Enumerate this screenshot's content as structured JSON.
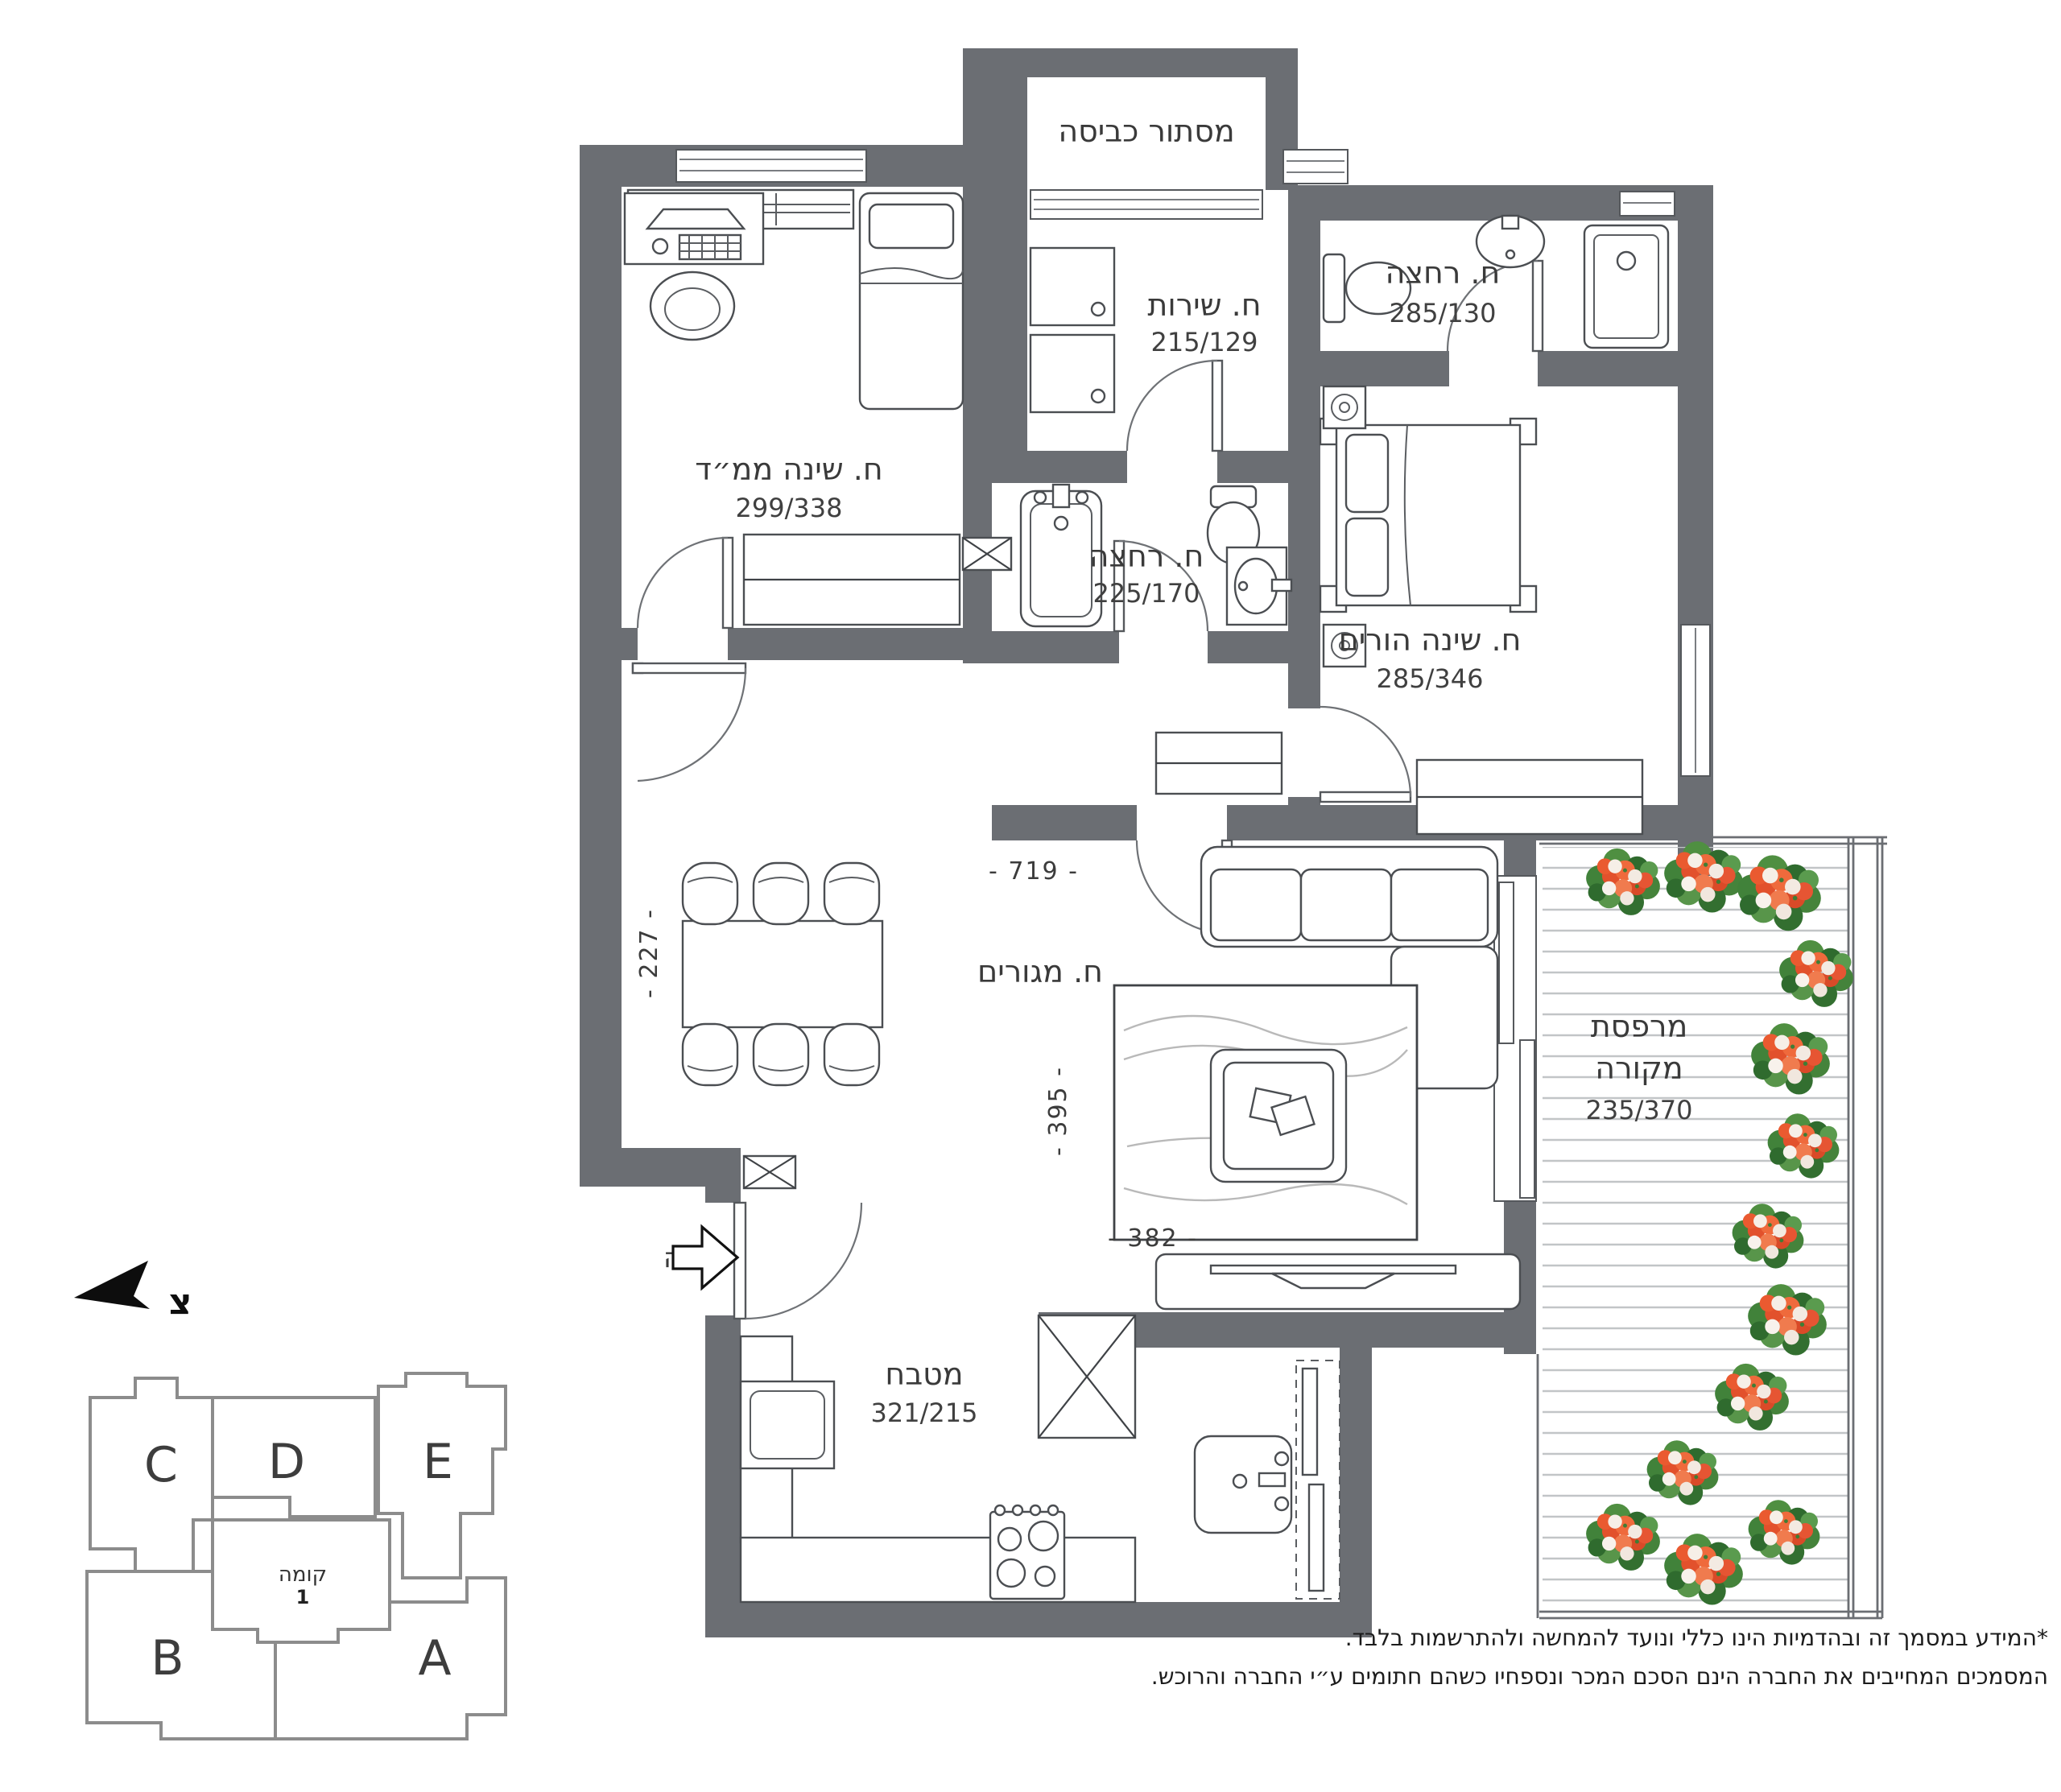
{
  "plan": {
    "rooms": {
      "laundry": {
        "name": "מסתור כביסה"
      },
      "wc": {
        "name": "ח. שירות",
        "dims": "215/129"
      },
      "bath_top": {
        "name": "ח. רחצה",
        "dims": "285/130"
      },
      "mamad": {
        "name": "ח. שינה ממ״ד",
        "dims": "299/338"
      },
      "bath_mid": {
        "name": "ח. רחצה",
        "dims": "225/170"
      },
      "master": {
        "name": "ח. שינה הורים",
        "dims": "285/346"
      },
      "living": {
        "name": "ח. מגורים"
      },
      "kitchen": {
        "name": "מטבח",
        "dims": "321/215"
      },
      "balcony": {
        "name_line1": "מרפסת",
        "name_line2": "מקורה",
        "dims": "235/370"
      }
    },
    "dimensions": {
      "d719": "- 719 -",
      "d227": "- 227 -",
      "d395": "- 395 -",
      "d382": "- 382 -"
    },
    "entrance_label": "כניסה",
    "north_letter": "צ"
  },
  "keyplan": {
    "units": [
      {
        "label": "A"
      },
      {
        "label": "B"
      },
      {
        "label": "C"
      },
      {
        "label": "D"
      },
      {
        "label": "E"
      }
    ],
    "floor_label": "קומה",
    "floor_number": "1",
    "highlight_color": "#9b9b99"
  },
  "disclaimer": {
    "line1": "*המידע במסמך זה ובהדמיות הינו כללי ונועד להמחשה ולהתרשמות בלבד.",
    "line2": "המסמכים המחייבים את החברה הינם הסכם המכר ונספחיו כשהם חתומים ע״י החברה והרוכש."
  },
  "colors": {
    "wall": "#6b6e73",
    "deck_line": "#c2c5c7"
  }
}
